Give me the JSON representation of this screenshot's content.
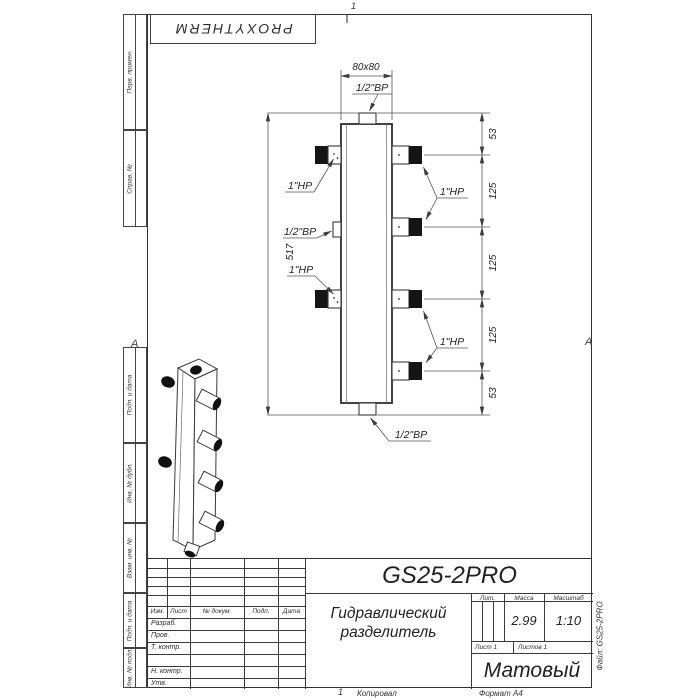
{
  "brand": {
    "logo": "PROXYTHERM"
  },
  "sheet": {
    "zone_top": "1",
    "zone_bottom": "1",
    "fold_left": "А",
    "fold_right": "А",
    "copied": "Копировал",
    "format": "Формат А4",
    "file": "Файл: GS25-2PRO"
  },
  "margin_boxes": [
    {
      "label": "Перв. примен."
    },
    {
      "label": "Справ. №"
    },
    {
      "label": "Подп. и дата"
    },
    {
      "label": "Инв. № дубл."
    },
    {
      "label": "Взам. инв. №"
    },
    {
      "label": "Подп. и дата"
    },
    {
      "label": "Инв. № подл."
    }
  ],
  "drawing": {
    "dim_width": "80x80",
    "dim_height": "517",
    "chain": [
      "53",
      "125",
      "125",
      "125",
      "53"
    ],
    "labels": {
      "top": "1/2\"ВР",
      "bottom": "1/2\"ВР",
      "left_top": "1\"НР",
      "left_mid": "1/2\"ВР",
      "left_bottom": "1\"НР",
      "right_top": "1\"НР",
      "right_bottom": "1\"НР"
    }
  },
  "title_block": {
    "designation": "GS25-2PRO",
    "name1": "Гидравлический",
    "name2": "разделитель",
    "cols": [
      "Изм.",
      "Лист",
      "№ докум.",
      "Подп.",
      "Дата"
    ],
    "rows": [
      "Разраб.",
      "Пров.",
      "Т. контр.",
      "Н. контр.",
      "Утв."
    ],
    "lit": "Лит.",
    "mass_label": "Масса",
    "scale_label": "Масштаб",
    "mass": "2.99",
    "scale": "1:10",
    "sheet_no": "Лист 1",
    "sheets": "Листов 1",
    "material": "Матовый"
  }
}
